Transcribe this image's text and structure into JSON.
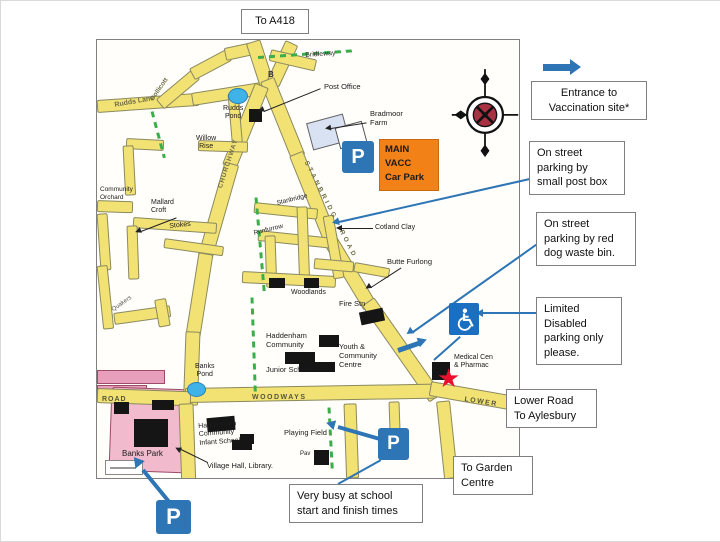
{
  "signs": {
    "to_a418": "To A418",
    "legend_entrance": "Entrance to\nVaccination site*",
    "post_box": "On street\nparking by\nsmall post box",
    "dog_waste": "On street\nparking by red\ndog waste bin.",
    "disabled": "Limited\nDisabled\nparking only\nplease.",
    "lower_road": "Lower Road\nTo Aylesbury",
    "garden_centre": "To Garden\nCentre",
    "school_busy": "Very busy at school\nstart and finish times"
  },
  "map": {
    "car_park_sign": "MAIN\nVACC\nCar Park",
    "p_label": "P",
    "road_labels": {
      "rudds_lane": "Rudds Lane",
      "dollicott": "Dollicott",
      "churchway": "CHURCHWAY",
      "stanbridge": "STANBRIDGE ROAD",
      "woodways": "WOODWAYS",
      "lower": "LOWER",
      "road_west": "ROAD",
      "bridleway": "Bridleway",
      "b_marker": "B"
    },
    "labels": {
      "post_office": "Post Office",
      "bradmoor_farm": "Bradmoor\nFarm",
      "rudds_pond": "Rudds\nPond",
      "willow_rise": "Willow\nRise",
      "community_orchard": "Community\nOrchard",
      "mallard_croft": "Mallard\nCroft",
      "stokes": "Stokes",
      "stanbridge_close": "Stanbridge",
      "runfurrow": "Runfurrow",
      "cotland_clay": "Cotland Clay",
      "butte_furlong": "Butte Furlong",
      "woodlands": "Woodlands",
      "fire_stn": "Fire Stn",
      "junior_school_1": "Haddenham\nCommunity",
      "junior_school_2": "Junior School",
      "youth_centre": "Youth &\nCommunity\nCentre",
      "medical": "Medical Cen\n& Pharmac",
      "banks_pond": "Banks\nPond",
      "banks_park": "Banks Park",
      "infant_school": "Haddenham\nCommunity\nInfant School",
      "village_hall": "Village Hall, Library.",
      "playing_field": "Playing Field",
      "pav": "Pav",
      "quakers": "Quakers"
    }
  },
  "colors": {
    "accent_blue": "#2E75B6",
    "car_park_orange": "#F28118",
    "road_yellow": "#F2E173",
    "path_green": "#3BAE4A",
    "pond_blue": "#3FB3E8",
    "park_pink": "#F2BACD",
    "star_red": "#E8112D",
    "disabled_blue": "#1B6FC0"
  }
}
